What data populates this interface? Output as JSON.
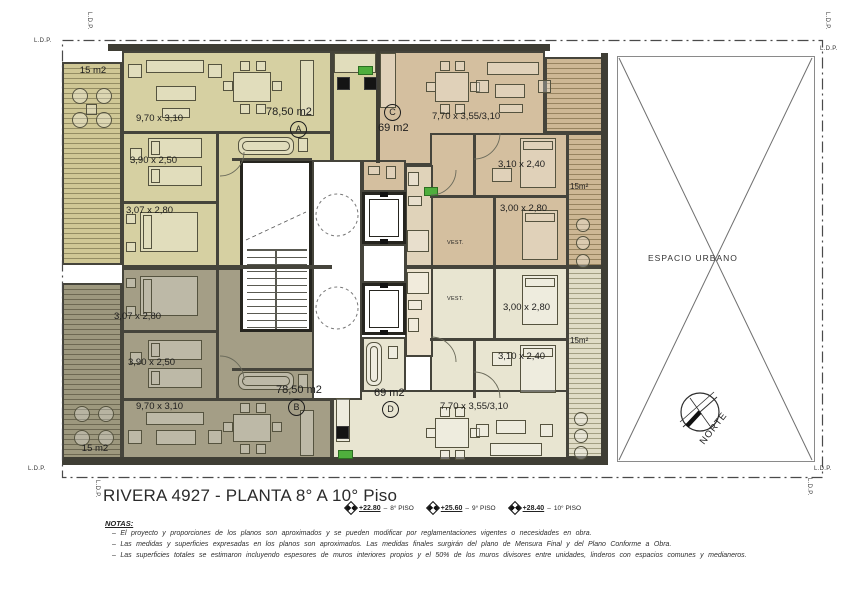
{
  "drawing": {
    "title": "RIVERA 4927  - PLANTA 8° A 10° Piso",
    "levels": [
      {
        "elevation": "+22.80",
        "floor": "8° PISO"
      },
      {
        "elevation": "+25.60",
        "floor": "9° PISO"
      },
      {
        "elevation": "+28.40",
        "floor": "10° PISO"
      }
    ],
    "notes_heading": "NOTAS:",
    "notes": [
      "–  El proyecto y proporciones de los planos son aproximados y se pueden modificar por reglamentaciones vigentes o necesidades en obra.",
      "–  Las medidas y superficies expresadas en los planos son aproximados. Las medidas finales surgirán del plano de Mensura Final y del Plano Conforme a Obra.",
      "–  Las superficies totales se estimaron incluyendo espesores de muros interiores propios y el 50% de los muros divisores entre unidades, linderos con espacios comunes y medianeros."
    ]
  },
  "site": {
    "open_space": "ESPACIO URBANO",
    "north": "NORTE",
    "property_line": "L.D.P."
  },
  "units": {
    "a": {
      "id": "A",
      "area": "78,50 m2",
      "living": "9,70 x 3,10",
      "bedroom1": "3,90 x 2,50",
      "bedroom2": "3,07 x 2,80",
      "balcony": "15 m2"
    },
    "b": {
      "id": "B",
      "area": "78,50 m2",
      "living": "9,70 x 3,10",
      "bedroom1": "3,90 x 2,50",
      "bedroom2": "3,07 x 2,80",
      "balcony": "15 m2"
    },
    "c": {
      "id": "C",
      "area": "69 m2",
      "living": "7,70 x 3,55/3,10",
      "bedroom1": "3,10 x 2,40",
      "bedroom2": "3,00 x 2,80",
      "balcony": "15m²",
      "vestibule": "VEST."
    },
    "d": {
      "id": "D",
      "area": "69 m2",
      "living": "7,70 x 3,55/3,10",
      "bedroom1": "3,10 x 2,40",
      "bedroom2": "3,00 x 2,80",
      "balcony": "15m²",
      "vestibule": "VEST."
    }
  },
  "colors": {
    "unit_a": "#d6d0a2",
    "unit_b": "#a49e86",
    "unit_c": "#d4bf9f",
    "unit_d": "#e8e5d1",
    "wall": "#45443b",
    "accent_green": "#4fae3d"
  }
}
